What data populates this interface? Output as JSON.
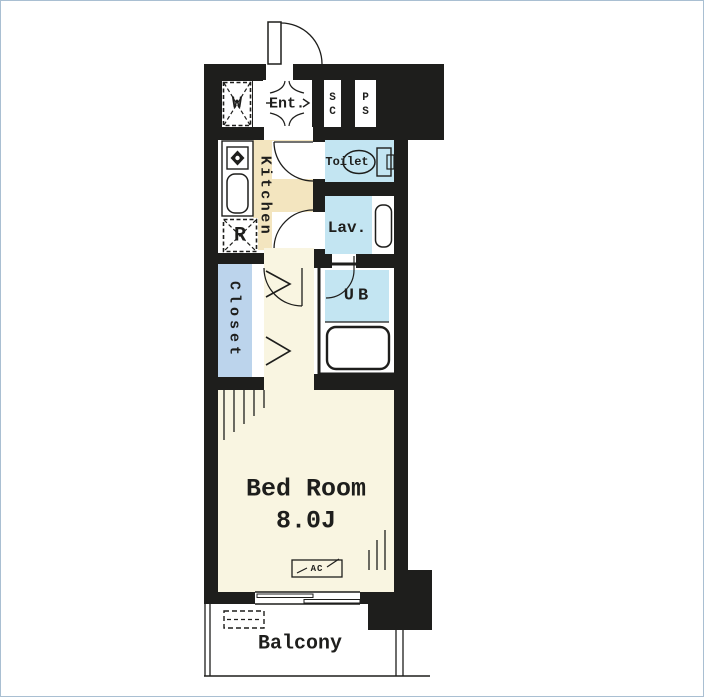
{
  "plan": {
    "type": "apartment-floor-plan",
    "labels": {
      "washer": "W",
      "entrance": "Ent.",
      "shoe_closet": [
        "S",
        "C"
      ],
      "pipe_space": [
        "P",
        "S"
      ],
      "kitchen": "Kitchen",
      "refrigerator": "R",
      "toilet": "Toilet",
      "lavatory": "Lav.",
      "closet": "Closet",
      "unit_bath": "UB",
      "bedroom_name": "Bed Room",
      "bedroom_size": "8.0J",
      "ac": "AC",
      "balcony": "Balcony"
    },
    "colors": {
      "wall": "#1e1e1c",
      "kitchen_floor": "#f3e5bf",
      "bedroom_floor": "#f9f5e1",
      "wet_area_blue": "#c3e5f2",
      "closet_blue": "#bcd4ec",
      "page_border": "#a9bfd2"
    }
  }
}
